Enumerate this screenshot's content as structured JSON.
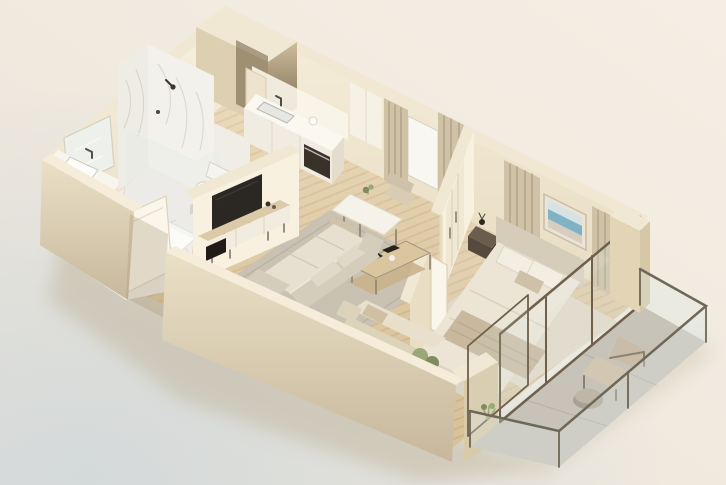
{
  "scene": {
    "description": "3D isometric floor plan rendering of a one-bedroom apartment in cream and beige tones",
    "rooms": [
      {
        "name": "bathroom",
        "items": [
          "mirror",
          "vanity-with-basin",
          "marble-shower-walls",
          "glass-shower",
          "toilet",
          "open-door",
          "marble-floor"
        ]
      },
      {
        "name": "entry-niche",
        "items": [
          "recessed-dark-entry"
        ]
      },
      {
        "name": "kitchen",
        "items": [
          "counter",
          "sink",
          "built-in-oven",
          "tall-cabinet",
          "herringbone-floor"
        ]
      },
      {
        "name": "dining-nook",
        "items": [
          "table",
          "two-chairs",
          "window",
          "curtains"
        ]
      },
      {
        "name": "living-room",
        "items": [
          "media-wall",
          "tv",
          "tv-console",
          "coffee-table",
          "rug",
          "sectional-sofa",
          "loveseat",
          "potted-plant"
        ]
      },
      {
        "name": "bedroom",
        "items": [
          "double-bed",
          "headboard",
          "pillows",
          "throw-blanket",
          "framed-seascape-art",
          "curtains",
          "wardrobe",
          "nightstand",
          "rug",
          "open-door"
        ]
      },
      {
        "name": "balcony",
        "items": [
          "glass-railing",
          "glass-sliding-doors",
          "lounge-chair",
          "round-side-table",
          "small-plant",
          "stone-floor"
        ]
      }
    ]
  },
  "colors": {
    "bg_warm_light": "#f4eee4",
    "bg_warm": "#efe9de",
    "bg_warm_dark": "#e8e3d8",
    "bg_blue": "#d2d8da",
    "ground_shadow": "#bfb49b",
    "wall_top": "#f1e8d3",
    "wall_top_light": "#f5edd9",
    "face_bright": "#f8f1e0",
    "face_mid": "#eadfc8",
    "face_kitchen": "#f6eedb",
    "face_kitchen_low": "#e7dbc1",
    "sw_top": "#eae0c6",
    "sw_bottom": "#c7b89d",
    "entry_top": "#cdbc9c",
    "entry_dark": "#6e5c42",
    "entry_side": "#dccfb2",
    "wood": "#e4cfa7",
    "wood_line": "#bfa076",
    "marble_floor": "#f0ede7",
    "marble_vein": "#c9c4b8",
    "marble_wall": "#f3f1ec",
    "marble_wall2": "#eeece5",
    "stone": "#c8c3b9",
    "stone_line": "#aaa499",
    "rug_living": "#c8c1b2",
    "rug_living_edge": "#b2aa9a",
    "rug_bed": "#e1dac9",
    "sofa_body": "#d5cdbc",
    "sofa_cushion": "#e7e0d1",
    "sofa_accent": "#e0d8c8",
    "loveseat": "#e8e0cc",
    "loveseat_back": "#ddd2ba",
    "tv": "#2b2723",
    "console_wood": "#dcc9a8",
    "console_front": "#f2ece0",
    "hifi": "#201b16",
    "counter_front": "#f1ece1",
    "counter_top": "#fbf8f2",
    "counter_side": "#e4ddcd",
    "oven": "#38322b",
    "sink": "#e6e6e2",
    "curtain": "#cfc2a7",
    "curtain_fold": "#a79a7f",
    "window": "#f8f7f2",
    "art_frame": "#eae4d6",
    "art_sky": "#d6e2e3",
    "art_sea": "#7fb2c5",
    "art_sand": "#d8cec0",
    "duvet": "#ece5d6",
    "throw": "#c8b89e",
    "pillow": "#f3eee2",
    "headboard": "#d5ccba",
    "nightstand_top": "#6b5d4e",
    "nightstand": "#554a3d",
    "door_white": "#faf6ec",
    "glass": "#dfe8e6",
    "glass_frame": "#6e604c",
    "rail_frame": "#6f6757",
    "chair_tan": "#c9bda9",
    "chair_seat": "#d2c7b2",
    "chair_frame": "#8e8170",
    "plant": "#7f8c60",
    "plant2": "#9aa878",
    "table_white": "#f5f2ea",
    "chair_dining": "#cec2aa",
    "chair_dining2": "#d8ccb4",
    "pillar_a": "#e2d4b4",
    "pillar_b": "#d6c7a6",
    "shadow_soft": "#8d7f66"
  }
}
